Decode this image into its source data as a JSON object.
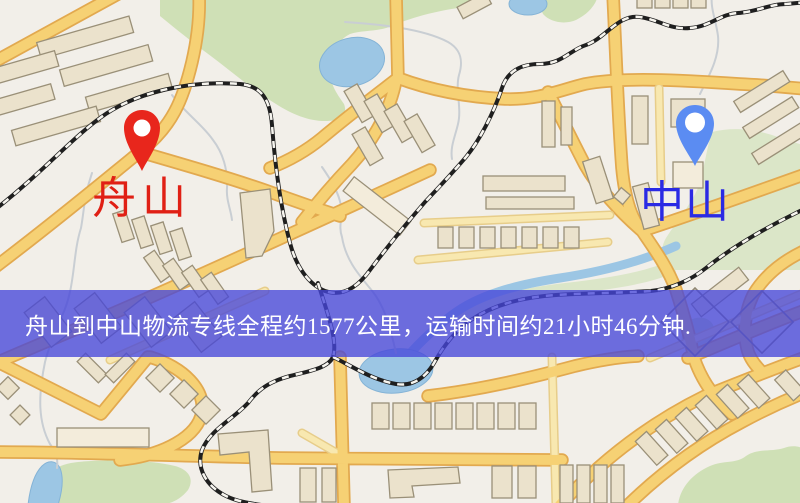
{
  "banner": {
    "text": "舟山到中山物流专线全程约1577公里，运输时间约21小时46分钟.",
    "background_color": "#4646da",
    "background_opacity": "0.78",
    "text_color": "#ffffff"
  },
  "origin": {
    "name": "舟山",
    "pin_color": "#e8261c",
    "label_color": "#e02015"
  },
  "destination": {
    "name": "中山",
    "pin_color": "#5b8cf2",
    "label_color": "#2a2ae4"
  },
  "map_palette": {
    "background": "#f2efe9",
    "park": "#cfe0b6",
    "water": "#9cc6e4",
    "road": "#f6d174",
    "building": "#ebe2cc",
    "railway": "#1f1f1f"
  }
}
